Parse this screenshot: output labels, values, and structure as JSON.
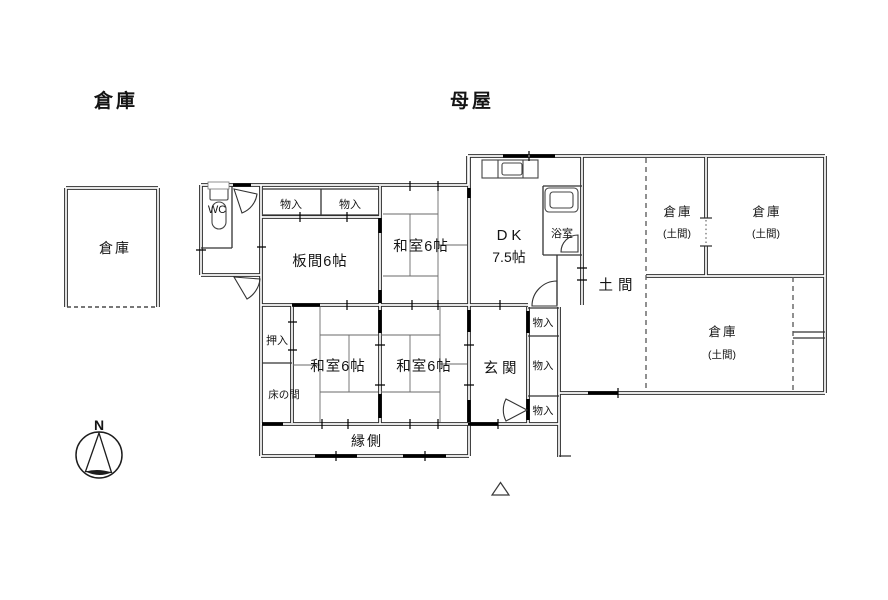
{
  "titles": {
    "outbuilding": "倉庫",
    "main_house": "母屋"
  },
  "rooms": {
    "outbuilding_label": "倉庫",
    "wc": "WC",
    "closet_top_1": "物入",
    "closet_top_2": "物入",
    "itanoma": "板間6帖",
    "washitsu_north": "和室6帖",
    "dk_name": "DK",
    "dk_size": "7.5帖",
    "bath": "浴室",
    "doma": "土間",
    "storage_ne_small_name": "倉庫",
    "storage_ne_small_sub": "(土間)",
    "storage_ne_large_name": "倉庫",
    "storage_ne_large_sub": "(土間)",
    "storage_east_name": "倉庫",
    "storage_east_sub": "(土間)",
    "oshiire": "押入",
    "tokonoma": "床の間",
    "washitsu_sw": "和室6帖",
    "washitsu_se": "和室6帖",
    "genkan": "玄関",
    "closet_e_1": "物入",
    "closet_e_2": "物入",
    "closet_e_3": "物入",
    "engawa": "縁側"
  },
  "compass": {
    "north": "N"
  }
}
